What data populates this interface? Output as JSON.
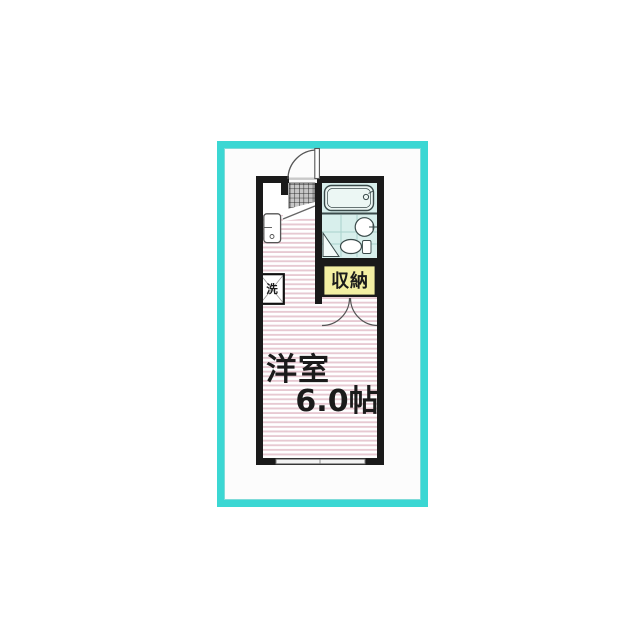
{
  "floorplan": {
    "description": "one-room apartment floor plan",
    "rooms": {
      "main_room": {
        "label": "洋室",
        "size": "6.0帖"
      },
      "closet": {
        "label": "収納"
      },
      "laundry_space": {
        "label": "洗"
      }
    },
    "fixtures": {
      "entrance_door": "swing-door-arc",
      "genkan": "tiled-entrance-step",
      "bathtub": "unit-bath-tub",
      "washbasin": "round-basin",
      "toilet": "toilet-bowl",
      "sink_unit": "compact-sink",
      "washing_machine_space": "crossed-square",
      "closet_doors": "double-swing-arcs",
      "window_south": "sliding-window"
    },
    "colors": {
      "frame": "#3bd7d3",
      "wall": "#1a1a1a",
      "floor_stripe": "#e7c9d2",
      "bathroom_bg": "#d8efec",
      "bathroom_grid": "#a9d2cc",
      "closet_bg": "#f3efa3",
      "tile_bg": "#c6c6c6",
      "text": "#1b1b1b"
    }
  }
}
